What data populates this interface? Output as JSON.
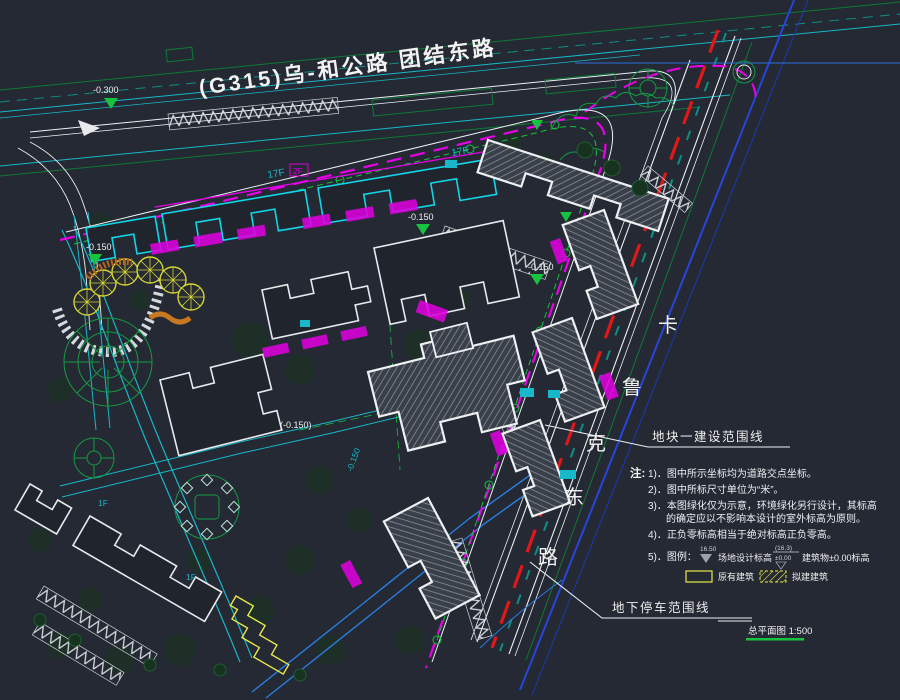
{
  "colors": {
    "background": "#242933",
    "cyan": "#18b7c9",
    "bright_cyan": "#10d6e8",
    "green": "#17c23e",
    "dark_green": "#0e7a36",
    "magenta": "#e800e8",
    "red_centerline": "#e01818",
    "yellow": "#e8e84a",
    "blue": "#2746d8",
    "white": "#eef0f3",
    "hatch_gray": "#9096a0"
  },
  "title": {
    "main_road_label": "(G315)乌-和公路 团结东路"
  },
  "east_road": {
    "name": "卡鲁克东路",
    "chars": [
      "卡",
      "鲁",
      "克",
      "东",
      "路"
    ]
  },
  "annotations": {
    "plot_boundary_label": "地块一建设范围线",
    "underground_parking_label": "地下停车范围线"
  },
  "caption": {
    "drawing_name": "总平面图 1:500"
  },
  "elevations": {
    "e1": "-0.300",
    "e2": "-0.150",
    "e3": "-0.150",
    "e4": "-0.150",
    "e5": "(-0.150)",
    "e6": "-0.150"
  },
  "building_labels": {
    "tower_a": "17F",
    "tower_b": "17F",
    "podium": "2F",
    "low_a": "1F",
    "low_b": "1F"
  },
  "notes": {
    "heading": "注:",
    "items": [
      "1)．图中所示坐标均为道路交点坐标。",
      "2)．图中所标尺寸单位为“米”。",
      "3)．本图绿化仅为示意，环境绿化另行设计，其标高",
      "的确定应以不影响本设计的室外标高为原则。",
      "4)．正负零标高相当于绝对标高正负零高。",
      "5)．图例："
    ],
    "legend": {
      "site_elev_value": "16.50",
      "site_elev_label": "场地设计标高",
      "bldg_elev_top": "(16.3)",
      "bldg_elev_bottom": "±0.00",
      "bldg_elev_label": "建筑物±0.00标高",
      "existing_label": "原有建筑",
      "proposed_label": "拟建建筑"
    }
  }
}
